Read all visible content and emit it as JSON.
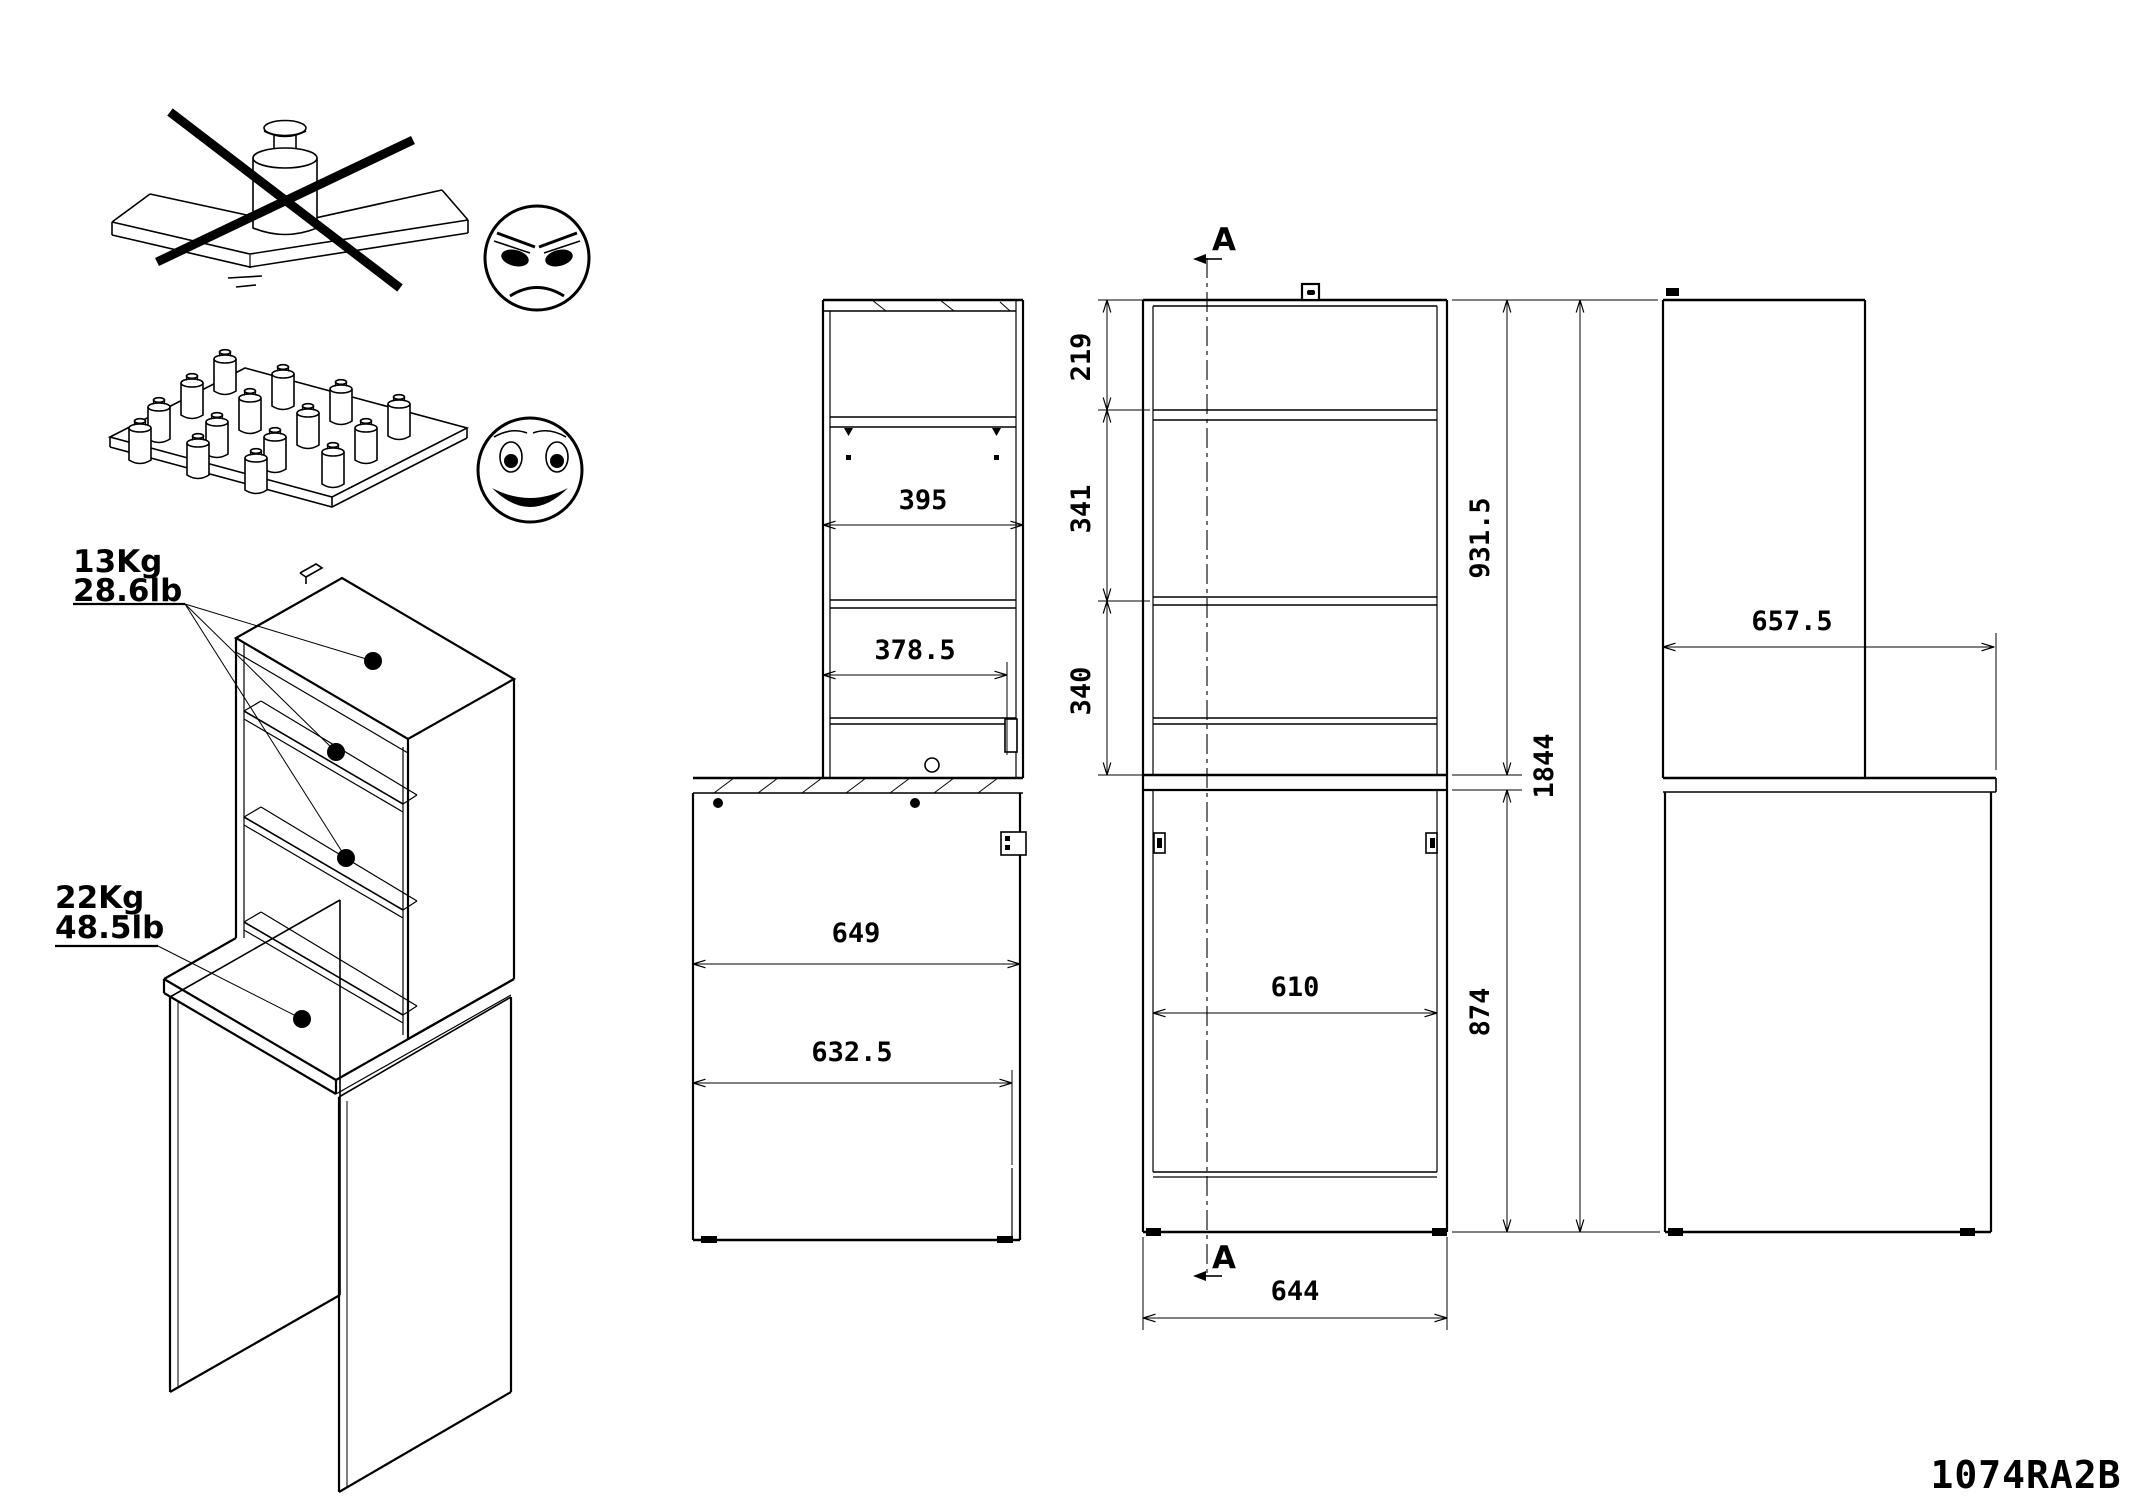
{
  "part_number": "1074RA2B",
  "section": {
    "label_top": "A",
    "label_bottom": "A"
  },
  "weights": {
    "shelf_kg": "13Kg",
    "shelf_lb": "28.6lb",
    "desk_kg": "22Kg",
    "desk_lb": "48.5lb"
  },
  "dims": {
    "side": {
      "hutch_depth": "395",
      "shelf_depth": "378.5",
      "desk_depth": "649",
      "desk_inner_depth": "632.5"
    },
    "front": {
      "top_gap": "219",
      "shelf_gap_1": "341",
      "shelf_gap_2": "340",
      "hutch_height": "931.5",
      "desk_height": "874",
      "total_height": "1844",
      "inner_width": "610",
      "outer_width": "644"
    },
    "right": {
      "desktop_depth": "657.5"
    }
  }
}
